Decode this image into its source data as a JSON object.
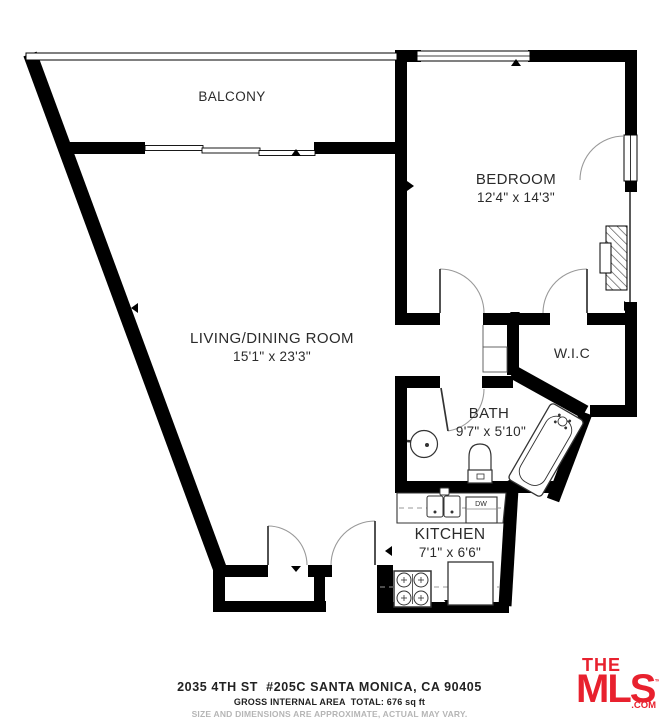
{
  "plan": {
    "rooms": {
      "balcony": {
        "label": "BALCONY"
      },
      "bedroom": {
        "label": "BEDROOM",
        "dims": "12'4\" x 14'3\""
      },
      "living_dining": {
        "label": "LIVING/DINING ROOM",
        "dims": "15'1\" x 23'3\""
      },
      "wic": {
        "label": "W.I.C"
      },
      "bath": {
        "label": "BATH",
        "dims": "9'7\" x 5'10\""
      },
      "kitchen": {
        "label": "KITCHEN",
        "dims": "7'1\" x 6'6\""
      }
    },
    "fixtures": {
      "dishwasher_label": "DW"
    },
    "wall_color": "#000000"
  },
  "footer": {
    "address": "2035 4TH ST  #205C SANTA MONICA, CA 90405",
    "area": "GROSS INTERNAL AREA  TOTAL: 676 sq ft",
    "disclaimer": "SIZE AND DIMENSIONS ARE APPROXIMATE, ACTUAL MAY VARY."
  },
  "logo": {
    "the": "THE",
    "mls": "MLS",
    "tm": "™",
    "com": ".COM",
    "color": "#e8212e"
  }
}
